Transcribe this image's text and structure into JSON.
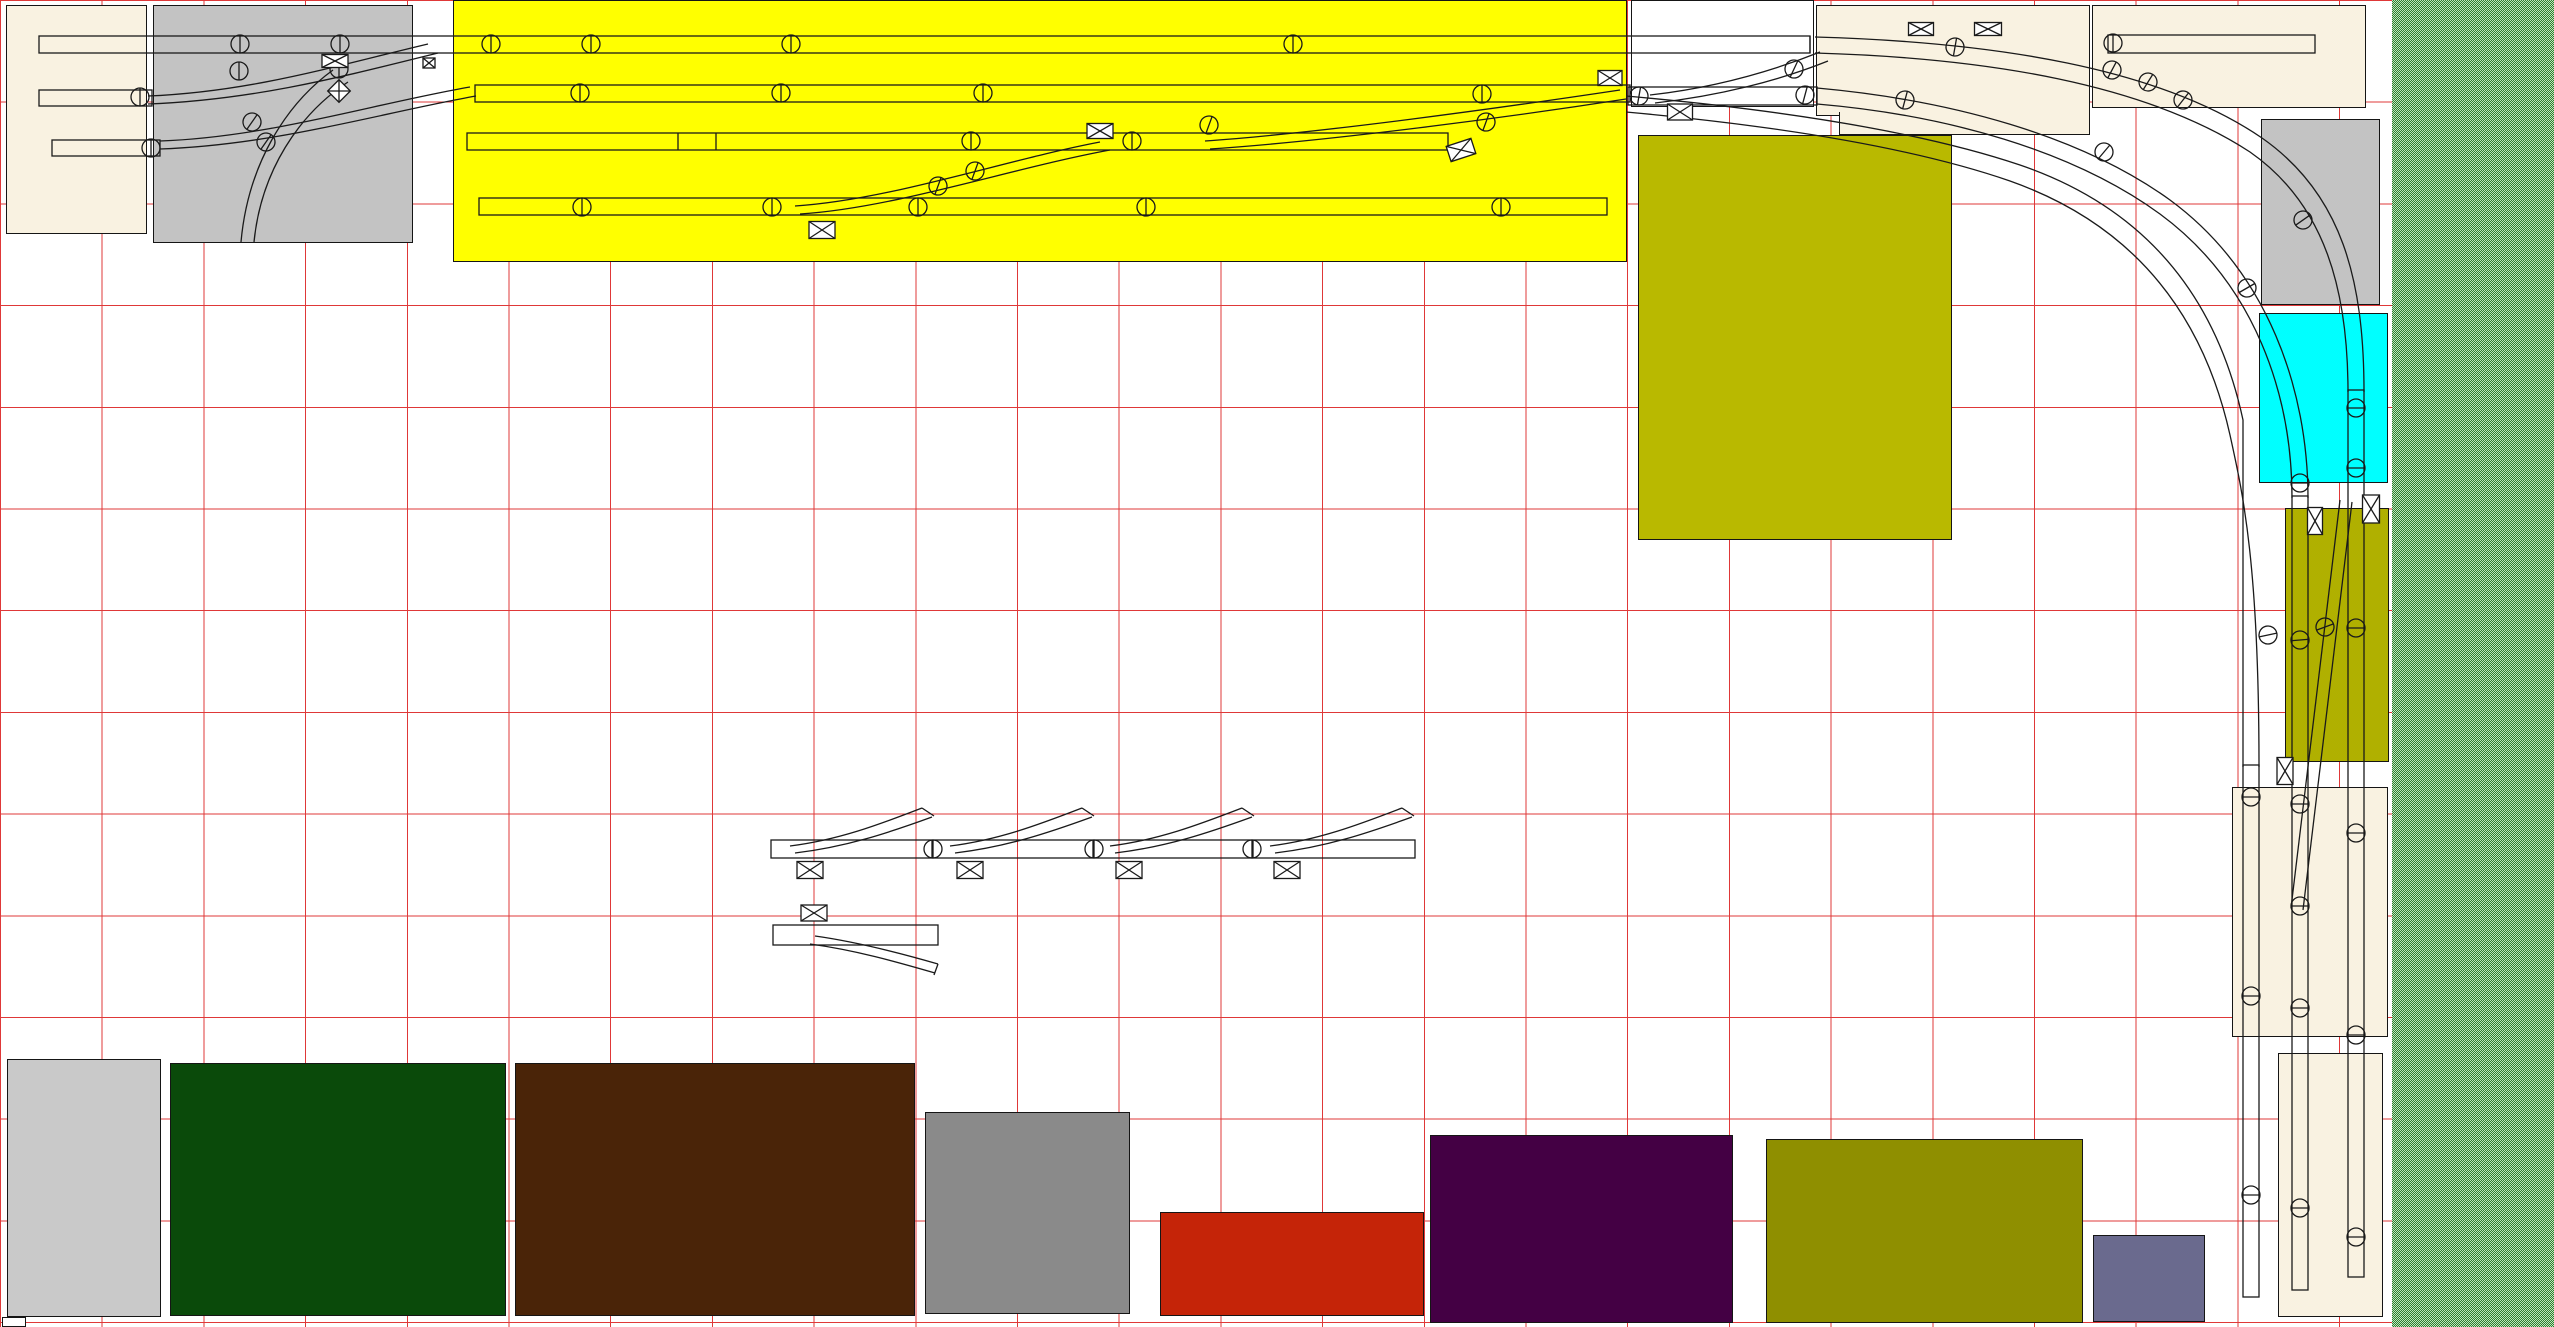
{
  "app": {
    "name": "track-plan-canvas",
    "title": "Model railroad track plan canvas"
  },
  "canvas": {
    "width": 2554,
    "height": 1327,
    "background": "#ffffff"
  },
  "grid": {
    "spacing": 101.7,
    "line_px": 1,
    "color": "#df3838"
  },
  "colors": {
    "yellow": "#ffff00",
    "cream": "#f9f2e1",
    "silver": "#c3c3c3",
    "white": "#ffffff",
    "cyan": "#00ffff",
    "olive_central": "#b9b900",
    "olive_right": "#b0b000",
    "olive_south": "#8f8f00",
    "gray_light": "#c9c9c9",
    "gray_mid": "#8a8a8a",
    "dark_green": "#0a4a0a",
    "brown": "#4a2408",
    "red": "#c52408",
    "purple": "#440044",
    "slate": "#6a6a8e",
    "grid_line": "#df3838",
    "track": "#1a1a1a",
    "green_strip_dark": "#2f7d2f",
    "green_strip_light": "#bce6bc"
  },
  "regions": [
    {
      "name": "room-cream-nw",
      "color": "cream",
      "style": "left:6px;top:5px;width:141px;height:229px"
    },
    {
      "name": "board-gray-nw",
      "color": "silver",
      "style": "left:153px;top:5px;width:260px;height:238px"
    },
    {
      "name": "yard-yellow",
      "color": "yellow",
      "style": "left:453px;top:0px;width:1174px;height:262px"
    },
    {
      "name": "board-white-top",
      "color": "white",
      "style": "left:1631px;top:0px;width:183px;height:107px"
    },
    {
      "name": "board-cream-top-a",
      "color": "cream",
      "style": "left:1816px;top:5px;width:274px;height:111px"
    },
    {
      "name": "board-cream-top-a2",
      "color": "cream",
      "style": "left:1839px;top:112px;width:251px;height:23px;border-top:none"
    },
    {
      "name": "board-cream-top-b",
      "color": "cream",
      "style": "left:2092px;top:5px;width:274px;height:103px"
    },
    {
      "name": "board-olive-central",
      "color": "olive_central",
      "style": "left:1638px;top:135px;width:314px;height:405px"
    },
    {
      "name": "board-gray-right",
      "color": "silver",
      "style": "left:2261px;top:119px;width:119px;height:186px"
    },
    {
      "name": "board-cyan-right",
      "color": "cyan",
      "style": "left:2259px;top:313px;width:129px;height:170px"
    },
    {
      "name": "board-olive-right",
      "color": "olive_right",
      "style": "left:2285px;top:508px;width:104px;height:254px"
    },
    {
      "name": "board-cream-right-mid",
      "color": "cream",
      "style": "left:2232px;top:787px;width:156px;height:250px"
    },
    {
      "name": "board-cream-right-bot",
      "color": "cream",
      "style": "left:2278px;top:1053px;width:105px;height:264px"
    },
    {
      "name": "scenery-green-strip",
      "color": "green_strip_dark",
      "texture": true,
      "style": "left:2392px;top:0px;width:162px;height:1327px"
    },
    {
      "name": "board-gray-sw",
      "color": "gray_light",
      "style": "left:7px;top:1059px;width:154px;height:258px"
    },
    {
      "name": "board-dark-green",
      "color": "dark_green",
      "style": "left:170px;top:1063px;width:336px;height:253px"
    },
    {
      "name": "board-brown",
      "color": "brown",
      "style": "left:515px;top:1063px;width:400px;height:253px"
    },
    {
      "name": "board-gray-south",
      "color": "gray_mid",
      "style": "left:925px;top:1112px;width:205px;height:202px"
    },
    {
      "name": "board-red",
      "color": "red",
      "style": "left:1160px;top:1212px;width:264px;height:104px"
    },
    {
      "name": "board-purple",
      "color": "purple",
      "style": "left:1430px;top:1135px;width:303px;height:188px"
    },
    {
      "name": "board-olive-south",
      "color": "olive_south",
      "style": "left:1766px;top:1139px;width:317px;height:184px"
    },
    {
      "name": "board-slate",
      "color": "slate",
      "style": "left:2093px;top:1235px;width:112px;height:87px"
    },
    {
      "name": "chip-white-sw",
      "color": "white",
      "style": "left:2px;top:1317px;width:24px;height:10px"
    }
  ],
  "tracks": {
    "rects": [
      {
        "name": "yard-track-1",
        "x": 39,
        "y": 36,
        "w": 1771,
        "h": 17
      },
      {
        "name": "yard-track-2",
        "x": 475,
        "y": 85,
        "w": 1155,
        "h": 17
      },
      {
        "name": "yard-track-2-ext",
        "x": 1628,
        "y": 87,
        "w": 189,
        "h": 18
      },
      {
        "name": "yard-track-3",
        "x": 467,
        "y": 133,
        "w": 981,
        "h": 17
      },
      {
        "name": "yard-track-4",
        "x": 479,
        "y": 198,
        "w": 1128,
        "h": 17
      },
      {
        "name": "stub-track-b",
        "x": 39,
        "y": 90,
        "w": 113,
        "h": 16
      },
      {
        "name": "stub-track-c",
        "x": 52,
        "y": 140,
        "w": 108,
        "h": 16
      },
      {
        "name": "stub-track-ne",
        "x": 2108,
        "y": 35,
        "w": 207,
        "h": 18
      },
      {
        "name": "ladder-straight",
        "x": 771,
        "y": 840,
        "w": 644,
        "h": 18
      },
      {
        "name": "turnout-straight",
        "x": 773,
        "y": 925,
        "w": 165,
        "h": 20
      },
      {
        "name": "vertical-track-a",
        "x": 2243,
        "y": 765,
        "w": 16,
        "h": 532
      },
      {
        "name": "vertical-track-b",
        "x": 2292,
        "y": 496,
        "w": 16,
        "h": 794
      },
      {
        "name": "vertical-track-c",
        "x": 2348,
        "y": 390,
        "w": 16,
        "h": 887
      }
    ],
    "ticks": [
      [
        716,
        133,
        716,
        150
      ],
      [
        678,
        133,
        678,
        150
      ],
      [
        932,
        840,
        932,
        858
      ],
      [
        1093,
        840,
        1093,
        858
      ],
      [
        1253,
        840,
        1253,
        858
      ],
      [
        1810,
        36,
        1810,
        53
      ]
    ],
    "curves": [
      {
        "name": "throat-curve-1a",
        "d": "M148,96 C250,92 335,66 428,44"
      },
      {
        "name": "throat-curve-1b",
        "d": "M148,104 C255,100 345,76 438,53"
      },
      {
        "name": "throat-curve-2a",
        "d": "M160,141 C270,137 372,104 470,87"
      },
      {
        "name": "throat-curve-2b",
        "d": "M160,149 C276,145 380,113 476,96"
      },
      {
        "name": "throat-curve-3a",
        "d": "M333,70 C286,104 248,164 241,242"
      },
      {
        "name": "throat-curve-3b",
        "d": "M348,82 C299,114 261,171 254,242"
      },
      {
        "name": "yard-diag-1a",
        "d": "M795,206 C890,200 1005,160 1100,142"
      },
      {
        "name": "yard-diag-1b",
        "d": "M800,214 C895,208 1012,168 1110,150"
      },
      {
        "name": "yard-diag-2a",
        "d": "M1205,141 C1320,133 1500,108 1620,90"
      },
      {
        "name": "yard-diag-2b",
        "d": "M1210,149 C1330,141 1510,117 1626,99"
      },
      {
        "name": "exit-diag-a",
        "d": "M1650,95 C1712,88 1770,72 1820,52"
      },
      {
        "name": "exit-diag-b",
        "d": "M1655,103 C1718,96 1778,81 1828,61"
      },
      {
        "name": "main-curve-a1",
        "d": "M1815,37 C1995,42 2160,68 2262,138 C2342,194 2364,280 2364,392"
      },
      {
        "name": "main-curve-a2",
        "d": "M1815,53 C1988,58 2146,84 2250,152 C2326,205 2348,292 2348,392"
      },
      {
        "name": "main-curve-b1",
        "d": "M1817,88 C1950,100 2080,135 2170,200 C2268,272 2308,390 2308,498"
      },
      {
        "name": "main-curve-b2",
        "d": "M1817,104 C1946,115 2072,150 2160,214 C2255,284 2292,395 2292,498"
      },
      {
        "name": "main-curve-c1",
        "d": "M1626,96 C1760,108 1910,128 2020,165 C2140,206 2215,290 2243,420 L2243,767"
      },
      {
        "name": "main-curve-c2",
        "d": "M1626,112 C1758,124 1903,144 2010,181 C2126,222 2201,305 2230,435 C2242,490 2259,560 2259,767"
      },
      {
        "name": "olive-crossover-a",
        "d": "M2352,502 L2303,910"
      },
      {
        "name": "olive-crossover-b",
        "d": "M2340,500 L2291,908"
      },
      {
        "name": "ladder-branch-1a",
        "d": "M790,846 C838,840 878,825 922,808"
      },
      {
        "name": "ladder-branch-1b",
        "d": "M795,853 C846,847 888,833 932,817"
      },
      {
        "name": "ladder-branch-1cap",
        "d": "M922,808 L934,816"
      },
      {
        "name": "ladder-branch-2a",
        "d": "M950,846 C998,840 1038,825 1082,808"
      },
      {
        "name": "ladder-branch-2b",
        "d": "M955,853 C1006,847 1048,833 1092,817"
      },
      {
        "name": "ladder-branch-2cap",
        "d": "M1082,808 L1094,816"
      },
      {
        "name": "ladder-branch-3a",
        "d": "M1110,846 C1158,840 1198,825 1242,808"
      },
      {
        "name": "ladder-branch-3b",
        "d": "M1115,853 C1166,847 1208,833 1252,817"
      },
      {
        "name": "ladder-branch-3cap",
        "d": "M1242,808 L1254,816"
      },
      {
        "name": "ladder-branch-4a",
        "d": "M1270,846 C1318,840 1358,825 1402,808"
      },
      {
        "name": "ladder-branch-4b",
        "d": "M1275,853 C1326,847 1368,833 1412,817"
      },
      {
        "name": "ladder-branch-4cap",
        "d": "M1402,808 L1414,816"
      },
      {
        "name": "turnout-branch-a",
        "d": "M815,936 C858,942 900,953 938,964"
      },
      {
        "name": "turnout-branch-b",
        "d": "M810,944 C855,950 897,962 935,973"
      },
      {
        "name": "turnout-branch-cap",
        "d": "M938,964 L934,975"
      }
    ]
  },
  "symbols": {
    "endpoint_icon": "circle-with-bar",
    "switch_motor_icon": "box-with-x",
    "endpoints": [
      [
        140,
        97,
        0
      ],
      [
        151,
        148,
        0
      ],
      [
        240,
        44,
        0
      ],
      [
        239,
        71,
        0
      ],
      [
        252,
        122,
        35
      ],
      [
        266,
        142,
        35
      ],
      [
        340,
        44,
        0
      ],
      [
        339,
        69,
        0
      ],
      [
        491,
        44,
        0
      ],
      [
        591,
        44,
        0
      ],
      [
        791,
        44,
        0
      ],
      [
        1293,
        44,
        0
      ],
      [
        580,
        93,
        0
      ],
      [
        781,
        93,
        0
      ],
      [
        983,
        93,
        0
      ],
      [
        1482,
        94,
        0
      ],
      [
        1639,
        96,
        10
      ],
      [
        1805,
        95,
        15
      ],
      [
        971,
        141,
        0
      ],
      [
        1132,
        141,
        0
      ],
      [
        1486,
        122,
        20
      ],
      [
        582,
        207,
        0
      ],
      [
        772,
        207,
        0
      ],
      [
        918,
        207,
        0
      ],
      [
        1146,
        207,
        0
      ],
      [
        1501,
        207,
        0
      ],
      [
        938,
        186,
        20
      ],
      [
        975,
        171,
        20
      ],
      [
        1209,
        125,
        20
      ],
      [
        1794,
        69,
        25
      ],
      [
        1955,
        47,
        10
      ],
      [
        1905,
        100,
        15
      ],
      [
        2112,
        70,
        28
      ],
      [
        2148,
        82,
        32
      ],
      [
        2183,
        100,
        38
      ],
      [
        2113,
        43,
        0
      ],
      [
        2104,
        152,
        40
      ],
      [
        2247,
        288,
        60
      ],
      [
        2303,
        220,
        55
      ],
      [
        2356,
        408,
        90
      ],
      [
        2356,
        468,
        90
      ],
      [
        2300,
        483,
        90
      ],
      [
        2268,
        635,
        78
      ],
      [
        2300,
        640,
        85
      ],
      [
        2325,
        627,
        70
      ],
      [
        2356,
        628,
        90
      ],
      [
        2251,
        797,
        90
      ],
      [
        2300,
        804,
        90
      ],
      [
        2356,
        833,
        90
      ],
      [
        2300,
        906,
        90
      ],
      [
        2251,
        996,
        90
      ],
      [
        2300,
        1008,
        90
      ],
      [
        2356,
        1035,
        90
      ],
      [
        2251,
        1195,
        90
      ],
      [
        2300,
        1208,
        90
      ],
      [
        2356,
        1237,
        90
      ],
      [
        933,
        849,
        0
      ],
      [
        1094,
        849,
        0
      ],
      [
        1252,
        849,
        0
      ]
    ],
    "boxes": [
      [
        335,
        61,
        26,
        13,
        0
      ],
      [
        429,
        63,
        12,
        10,
        0
      ],
      [
        339,
        91,
        16,
        16,
        45
      ],
      [
        1610,
        78,
        24,
        15,
        0
      ],
      [
        1680,
        112,
        25,
        16,
        0
      ],
      [
        822,
        230,
        26,
        17,
        0
      ],
      [
        1100,
        131,
        26,
        15,
        0
      ],
      [
        1461,
        150,
        26,
        16,
        -18
      ],
      [
        1921,
        29,
        25,
        13,
        0
      ],
      [
        1988,
        29,
        27,
        13,
        0
      ],
      [
        2315,
        521,
        15,
        27,
        0
      ],
      [
        2371,
        509,
        17,
        28,
        0
      ],
      [
        2285,
        771,
        16,
        27,
        0
      ],
      [
        810,
        870,
        26,
        17,
        0
      ],
      [
        970,
        870,
        26,
        17,
        0
      ],
      [
        1129,
        870,
        26,
        17,
        0
      ],
      [
        1287,
        870,
        26,
        17,
        0
      ],
      [
        814,
        913,
        26,
        16,
        0
      ]
    ]
  }
}
